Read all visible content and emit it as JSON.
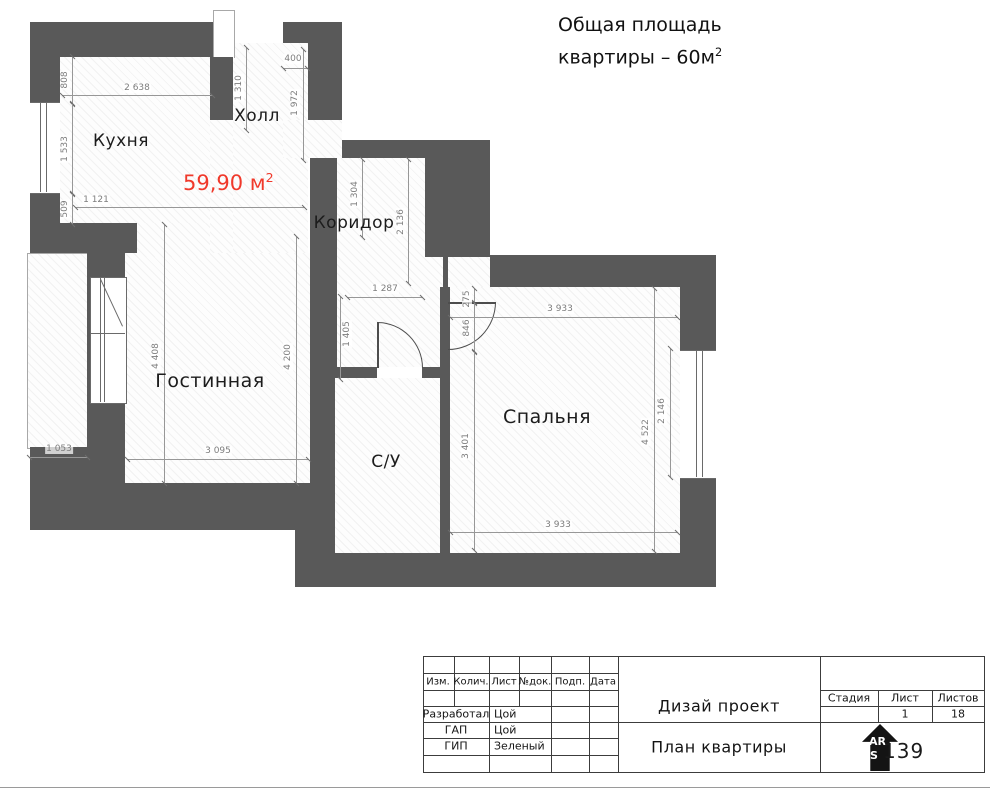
{
  "header": {
    "line1": "Общая площадь",
    "line2": "квартиры – 60м",
    "sup": "2"
  },
  "plan": {
    "wall_color": "#595959",
    "area_value": "59,90 м",
    "area_sup": "2",
    "area_color": "#f0392b",
    "rooms": [
      {
        "id": "kitchen",
        "label": "Кухня",
        "x": 121,
        "y": 141,
        "size": 17
      },
      {
        "id": "hall",
        "label": "Холл",
        "x": 257,
        "y": 116,
        "size": 17
      },
      {
        "id": "corridor",
        "label": "Коридор",
        "x": 354,
        "y": 223,
        "size": 17
      },
      {
        "id": "living",
        "label": "Гостинная",
        "x": 210,
        "y": 381,
        "size": 19
      },
      {
        "id": "bathroom",
        "label": "С/У",
        "x": 386,
        "y": 462,
        "size": 17
      },
      {
        "id": "bedroom",
        "label": "Спальня",
        "x": 547,
        "y": 417,
        "size": 19
      }
    ],
    "dimensions": [
      {
        "text": "808",
        "x": 65,
        "y": 80,
        "rot": 1
      },
      {
        "text": "1 533",
        "x": 65,
        "y": 149,
        "rot": 1
      },
      {
        "text": "509",
        "x": 65,
        "y": 209,
        "rot": 1
      },
      {
        "text": "2 638",
        "x": 137,
        "y": 88,
        "rot": 0
      },
      {
        "text": "1 121",
        "x": 96,
        "y": 200,
        "rot": 0
      },
      {
        "text": "1 310",
        "x": 239,
        "y": 88,
        "rot": 1
      },
      {
        "text": "400",
        "x": 293,
        "y": 59,
        "rot": 0
      },
      {
        "text": "1 972",
        "x": 295,
        "y": 103,
        "rot": 1
      },
      {
        "text": "1 304",
        "x": 355,
        "y": 194,
        "rot": 1
      },
      {
        "text": "2 136",
        "x": 401,
        "y": 222,
        "rot": 1
      },
      {
        "text": "1 287",
        "x": 385,
        "y": 289,
        "rot": 0
      },
      {
        "text": "1 405",
        "x": 347,
        "y": 334,
        "rot": 1
      },
      {
        "text": "275",
        "x": 467,
        "y": 299,
        "rot": 1
      },
      {
        "text": "846",
        "x": 467,
        "y": 328,
        "rot": 1
      },
      {
        "text": "3 933",
        "x": 560,
        "y": 309,
        "rot": 0
      },
      {
        "text": "3 401",
        "x": 466,
        "y": 446,
        "rot": 1
      },
      {
        "text": "4 522",
        "x": 646,
        "y": 432,
        "rot": 1
      },
      {
        "text": "2 146",
        "x": 662,
        "y": 411,
        "rot": 1
      },
      {
        "text": "3 933",
        "x": 558,
        "y": 525,
        "rot": 0
      },
      {
        "text": "4 408",
        "x": 156,
        "y": 356,
        "rot": 1
      },
      {
        "text": "4 200",
        "x": 288,
        "y": 357,
        "rot": 1
      },
      {
        "text": "3 095",
        "x": 218,
        "y": 451,
        "rot": 0
      },
      {
        "text": "1 053",
        "x": 59,
        "y": 449,
        "rot": 0
      }
    ]
  },
  "titleblock": {
    "columns": [
      "Изм.",
      "Колич.",
      "Лист",
      "№док.",
      "Подп.",
      "Дата"
    ],
    "roles": [
      {
        "role": "Разработал",
        "name": "Цой"
      },
      {
        "role": "ГАП",
        "name": "Цой"
      },
      {
        "role": "ГИП",
        "name": "Зеленый"
      }
    ],
    "project_title": "Дизай проект",
    "sheet_title": "План квартиры",
    "stage_label": "Стадия",
    "sheet_label": "Лист",
    "sheets_label": "Листов",
    "stage_value": "",
    "sheet_value": "1",
    "sheets_value": "18",
    "logo": {
      "top": "AR",
      "mid": "S",
      "number": "139"
    }
  }
}
